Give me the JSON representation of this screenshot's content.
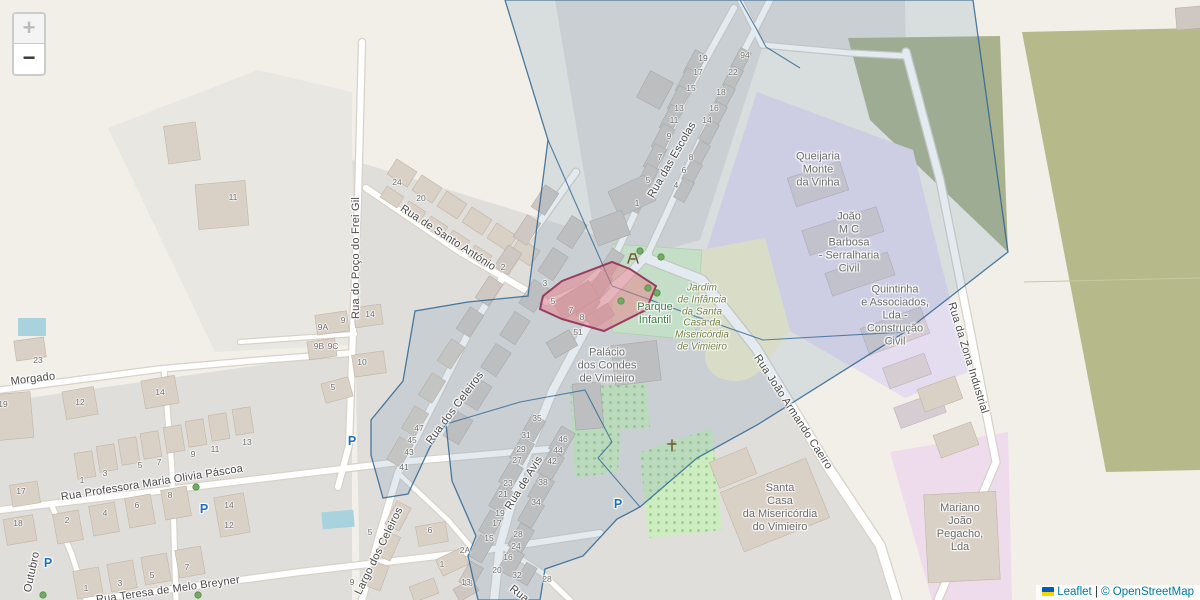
{
  "controls": {
    "zoom_in": "+",
    "zoom_out": "−"
  },
  "attribution": {
    "leaflet": "Leaflet",
    "separator": " | ",
    "osm": "© OpenStreetMap"
  },
  "colors": {
    "background": "#f2efe9",
    "parcel": "#e9e7e2",
    "residential": "#e0dedb",
    "industrial": "#e4ddef",
    "industrial_pink": "#eedcec",
    "olive_dark": "#aab28d",
    "olive_field": "#b6ba8b",
    "park": "#d9f0cd",
    "orchard": "#cdecc0",
    "orchard_dot": "#93d182",
    "school_yellow": "#f3efce",
    "water": "#a8d3de",
    "road_fill": "#ffffff",
    "road_casing": "#d8d2c8",
    "building": "#d9d0c6",
    "building_outline": "#c3b5a5",
    "building_gray": "#cfc8c2",
    "building_gray_outline": "#b5ada6",
    "building_purplezone": "#d5cdd2",
    "boundary_stroke": "#2f6691",
    "boundary_fill": "#7596b4",
    "selection_fill": "#ea7e88",
    "selection_stroke": "#8f3156",
    "tree": "#72ab61",
    "street_label": "#4b4b4b",
    "house_number": "#6e6e6e",
    "place_label": "#6d6d6d",
    "park_label": "#3f7d46",
    "garden_label": "#778445",
    "parking_blue": "#1f6fc0",
    "link": "#0078a8",
    "flag_blue": "#005BBB",
    "flag_yellow": "#FFD500"
  },
  "labels": {
    "streets": [
      {
        "text": "Rua do Poço do Frei Gil",
        "x": 356,
        "y": 258,
        "rot": -90
      },
      {
        "text": "Rua de Santo António",
        "x": 448,
        "y": 238,
        "rot": 33
      },
      {
        "text": "Rua das Escolas",
        "x": 672,
        "y": 160,
        "rot": -60
      },
      {
        "text": "Rua dos Celeiros",
        "x": 455,
        "y": 408,
        "rot": -53
      },
      {
        "text": "Largo dos Celeiros",
        "x": 379,
        "y": 551,
        "rot": -64
      },
      {
        "text": "Rua de Avis",
        "x": 524,
        "y": 483,
        "rot": -58
      },
      {
        "text": "Rua João Armando Caeiro",
        "x": 793,
        "y": 412,
        "rot": 57
      },
      {
        "text": "Rua da Zona Industrial",
        "x": 968,
        "y": 358,
        "rot": 73
      },
      {
        "text": "Morgado",
        "x": 33,
        "y": 379,
        "rot": -7
      },
      {
        "text": "Rua Professora Maria Olivia Páscoa",
        "x": 152,
        "y": 483,
        "rot": -9
      },
      {
        "text": "Rua Teresa de Melo Breyner",
        "x": 168,
        "y": 590,
        "rot": -8
      },
      {
        "text": "Outubro",
        "x": 32,
        "y": 572,
        "rot": -78
      },
      {
        "text": "Rua",
        "x": 519,
        "y": 594,
        "rot": 38
      }
    ],
    "places": [
      {
        "lines": [
          "Palácio",
          "dos Condes",
          "de Vimieiro"
        ],
        "x": 607,
        "y": 366,
        "kind": "place"
      },
      {
        "lines": [
          "Parque",
          "Infantil"
        ],
        "x": 655,
        "y": 314,
        "kind": "park"
      },
      {
        "lines": [
          "Jardim",
          "de Infância",
          "da Santa",
          "Casa da",
          "Misericórdia",
          "de Vimieiro"
        ],
        "x": 702,
        "y": 318,
        "kind": "garden"
      },
      {
        "lines": [
          "Queijaria",
          "Monte",
          "da Vinha"
        ],
        "x": 818,
        "y": 170,
        "kind": "place"
      },
      {
        "lines": [
          "João",
          "M C",
          "Barbosa",
          "- Serralharia",
          "Civil"
        ],
        "x": 849,
        "y": 243,
        "kind": "place"
      },
      {
        "lines": [
          "Quintinha",
          "e Associados,",
          "Lda -",
          "Construção",
          "Civil"
        ],
        "x": 895,
        "y": 316,
        "kind": "place"
      },
      {
        "lines": [
          "Santa",
          "Casa",
          "da Misericórdia",
          "do Vimieiro"
        ],
        "x": 780,
        "y": 508,
        "kind": "place"
      },
      {
        "lines": [
          "Mariano",
          "João",
          "Pegacho,",
          "Lda"
        ],
        "x": 960,
        "y": 528,
        "kind": "place"
      }
    ],
    "house_numbers": [
      [
        38,
        360,
        "23"
      ],
      [
        3,
        404,
        "19"
      ],
      [
        80,
        402,
        "12"
      ],
      [
        160,
        392,
        "14"
      ],
      [
        82,
        480,
        "1"
      ],
      [
        105,
        473,
        "3"
      ],
      [
        140,
        465,
        "5"
      ],
      [
        159,
        462,
        "7"
      ],
      [
        193,
        454,
        "9"
      ],
      [
        215,
        449,
        "11"
      ],
      [
        247,
        442,
        "13"
      ],
      [
        21,
        491,
        "17"
      ],
      [
        18,
        523,
        "18"
      ],
      [
        67,
        520,
        "2"
      ],
      [
        105,
        513,
        "4"
      ],
      [
        137,
        505,
        "6"
      ],
      [
        170,
        495,
        "8"
      ],
      [
        229,
        505,
        "14"
      ],
      [
        229,
        525,
        "12"
      ],
      [
        86,
        588,
        "1"
      ],
      [
        120,
        583,
        "3"
      ],
      [
        152,
        575,
        "5"
      ],
      [
        187,
        567,
        "7"
      ],
      [
        233,
        197,
        "11"
      ],
      [
        397,
        182,
        "24"
      ],
      [
        421,
        198,
        "20"
      ],
      [
        503,
        267,
        "2"
      ],
      [
        323,
        327,
        "9A"
      ],
      [
        343,
        320,
        "9"
      ],
      [
        319,
        346,
        "9B"
      ],
      [
        333,
        346,
        "9C"
      ],
      [
        370,
        314,
        "14"
      ],
      [
        362,
        362,
        "10"
      ],
      [
        333,
        387,
        "5"
      ],
      [
        419,
        428,
        "47"
      ],
      [
        412,
        440,
        "45"
      ],
      [
        409,
        452,
        "43"
      ],
      [
        404,
        467,
        "41"
      ],
      [
        537,
        418,
        "35"
      ],
      [
        526,
        435,
        "31"
      ],
      [
        521,
        449,
        "29"
      ],
      [
        517,
        460,
        "27"
      ],
      [
        508,
        483,
        "23"
      ],
      [
        503,
        494,
        "21"
      ],
      [
        500,
        513,
        "19"
      ],
      [
        497,
        523,
        "17"
      ],
      [
        489,
        538,
        "15"
      ],
      [
        468,
        583,
        "13"
      ],
      [
        563,
        439,
        "46"
      ],
      [
        558,
        450,
        "44"
      ],
      [
        552,
        461,
        "42"
      ],
      [
        543,
        482,
        "38"
      ],
      [
        536,
        502,
        "34"
      ],
      [
        518,
        534,
        "28"
      ],
      [
        516,
        546,
        "24"
      ],
      [
        508,
        557,
        "16"
      ],
      [
        497,
        570,
        "20"
      ],
      [
        517,
        575,
        "32"
      ],
      [
        547,
        579,
        "28"
      ],
      [
        370,
        532,
        "5"
      ],
      [
        352,
        582,
        "9"
      ],
      [
        430,
        530,
        "6"
      ],
      [
        442,
        564,
        "1"
      ],
      [
        466,
        582,
        "13"
      ],
      [
        465,
        550,
        "2A"
      ],
      [
        703,
        58,
        "19"
      ],
      [
        698,
        72,
        "17"
      ],
      [
        691,
        88,
        "15"
      ],
      [
        679,
        108,
        "13"
      ],
      [
        674,
        120,
        "11"
      ],
      [
        669,
        136,
        "9"
      ],
      [
        660,
        157,
        "7"
      ],
      [
        648,
        180,
        "5"
      ],
      [
        637,
        203,
        "1"
      ],
      [
        745,
        55,
        "94"
      ],
      [
        733,
        72,
        "22"
      ],
      [
        721,
        92,
        "18"
      ],
      [
        714,
        108,
        "16"
      ],
      [
        707,
        120,
        "14"
      ],
      [
        691,
        157,
        "8"
      ],
      [
        684,
        170,
        "6"
      ],
      [
        676,
        185,
        "4"
      ],
      [
        545,
        283,
        "3"
      ],
      [
        553,
        301,
        "5"
      ],
      [
        571,
        310,
        "7"
      ],
      [
        582,
        317,
        "8"
      ],
      [
        578,
        332,
        "51"
      ]
    ]
  },
  "markers": {
    "parking_label": "P",
    "parking": [
      [
        352,
        441
      ],
      [
        204,
        509
      ],
      [
        48,
        563
      ],
      [
        618,
        504
      ]
    ],
    "trees": [
      [
        196,
        487
      ],
      [
        43,
        595
      ],
      [
        198,
        595
      ],
      [
        648,
        288
      ],
      [
        657,
        293
      ],
      [
        640,
        251
      ],
      [
        661,
        257
      ],
      [
        621,
        301
      ]
    ],
    "wayside_cross": [
      672,
      446
    ],
    "playground": [
      633,
      259
    ]
  }
}
